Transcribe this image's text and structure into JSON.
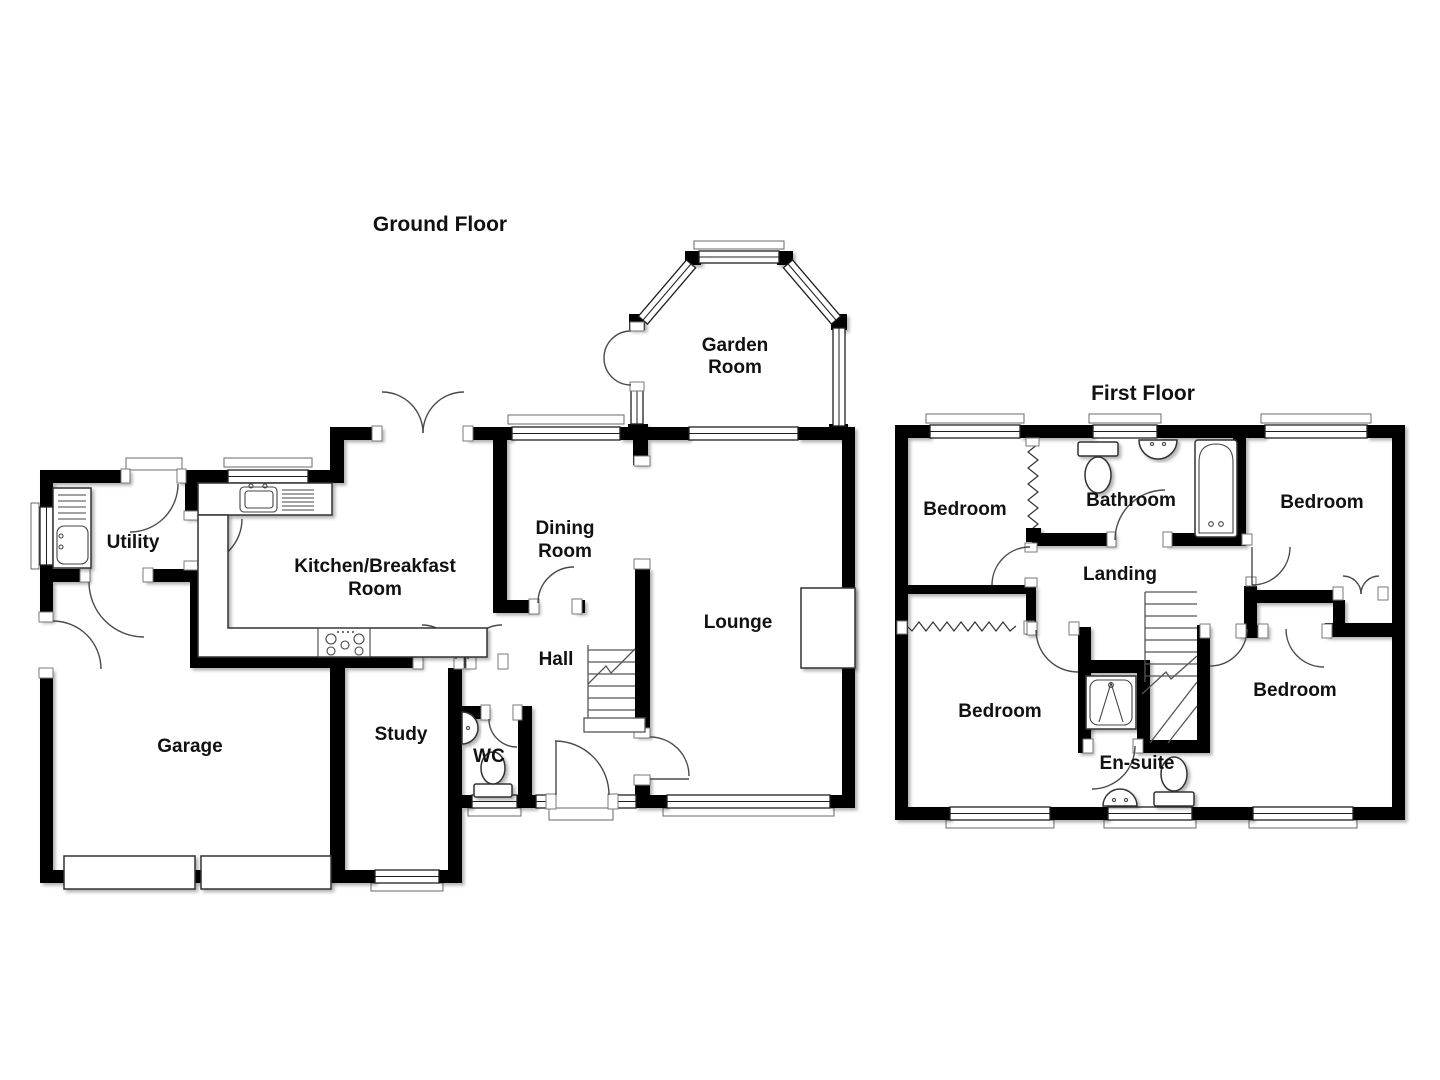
{
  "document": {
    "background": "#ffffff"
  },
  "palette": {
    "wall": "#000000",
    "floor": "#ffffff",
    "outline": "#3d3d3d",
    "label": "#111111"
  },
  "floors": [
    {
      "title": "Ground Floor",
      "rooms": [
        {
          "id": "garden-room",
          "lines": [
            "Garden",
            "Room"
          ]
        },
        {
          "id": "dining-room",
          "lines": [
            "Dining",
            "Room"
          ]
        },
        {
          "id": "kitchen-breakfast-room",
          "lines": [
            "Kitchen/Breakfast",
            "Room"
          ]
        },
        {
          "id": "utility",
          "lines": [
            "Utility"
          ]
        },
        {
          "id": "lounge",
          "lines": [
            "Lounge"
          ]
        },
        {
          "id": "hall",
          "lines": [
            "Hall"
          ]
        },
        {
          "id": "study",
          "lines": [
            "Study"
          ]
        },
        {
          "id": "wc",
          "lines": [
            "WC"
          ]
        },
        {
          "id": "garage",
          "lines": [
            "Garage"
          ]
        }
      ],
      "fixtures": [
        "kitchen-sink",
        "hob",
        "worktop",
        "utility-sink",
        "wc-toilet",
        "wc-basin",
        "staircase",
        "fireplace",
        "french-doors",
        "garden-room-bay-window",
        "front-door",
        "garage-door",
        "garage-door"
      ]
    },
    {
      "title": "First Floor",
      "rooms": [
        {
          "id": "bedroom-top-left",
          "lines": [
            "Bedroom"
          ]
        },
        {
          "id": "bathroom",
          "lines": [
            "Bathroom"
          ]
        },
        {
          "id": "bedroom-top-right",
          "lines": [
            "Bedroom"
          ]
        },
        {
          "id": "landing",
          "lines": [
            "Landing"
          ]
        },
        {
          "id": "bedroom-bottom-left",
          "lines": [
            "Bedroom"
          ]
        },
        {
          "id": "en-suite",
          "lines": [
            "En-suite"
          ]
        },
        {
          "id": "bedroom-bottom-right",
          "lines": [
            "Bedroom"
          ]
        }
      ],
      "fixtures": [
        "bath",
        "bathroom-toilet",
        "bathroom-basin",
        "shower-cubicle",
        "en-suite-toilet",
        "en-suite-basin",
        "staircase",
        "wardrobe",
        "wardrobe",
        "cupboard"
      ]
    }
  ]
}
